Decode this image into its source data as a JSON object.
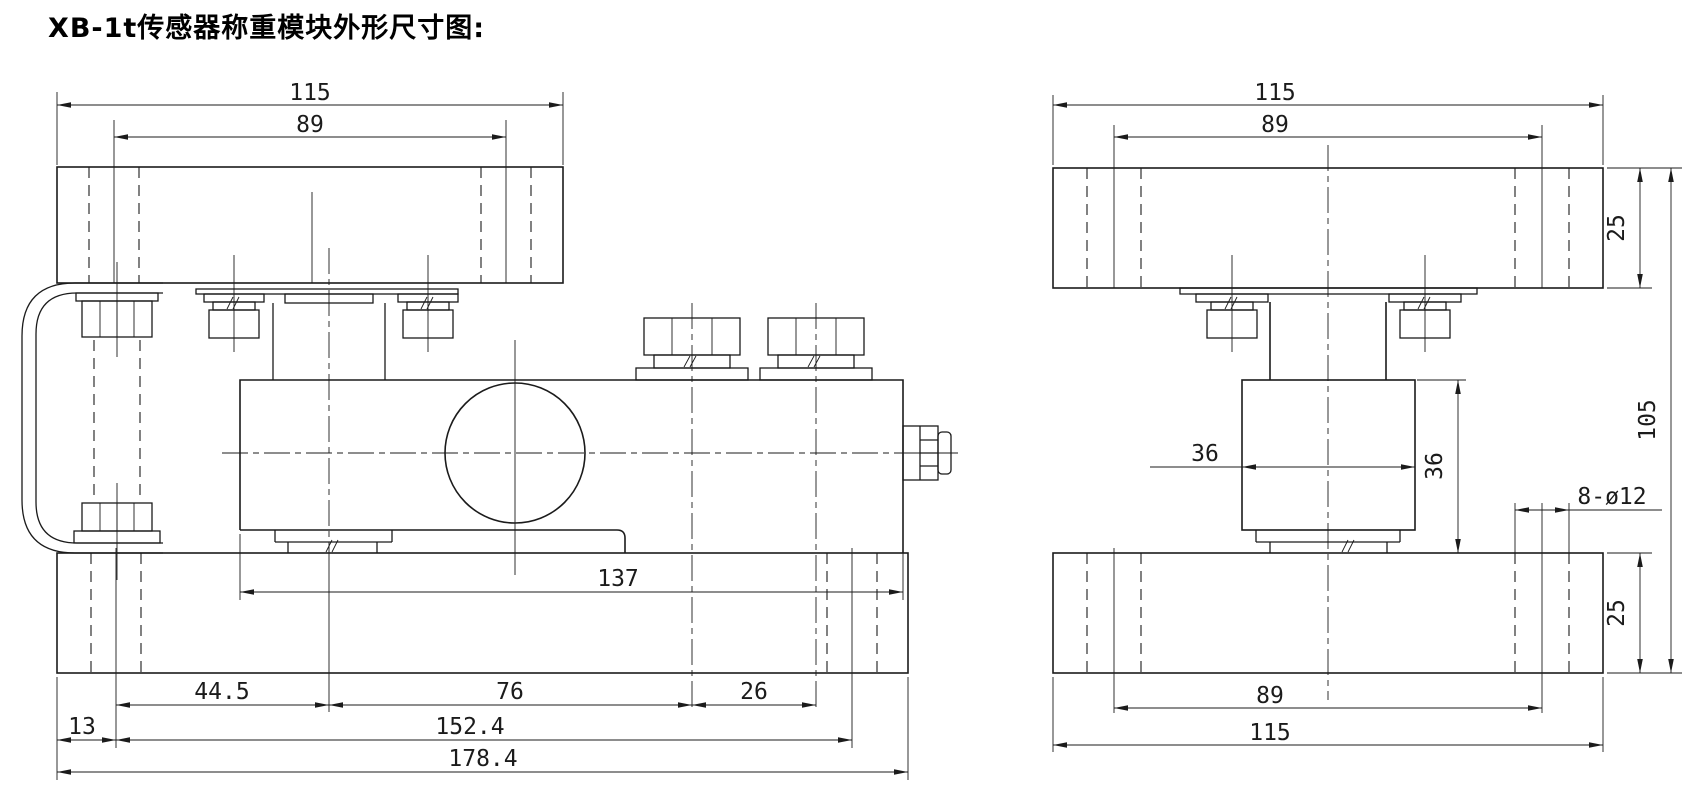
{
  "title": "XB-1t传感器称重模块外形尺寸图:",
  "side_view": {
    "dims": {
      "top_plate_width": "115",
      "top_hole_spacing": "89",
      "body_length": "137",
      "edge_to_hole": "13",
      "hole_to_center": "44.5",
      "center_to_bolt": "76",
      "bolt_spacing": "26",
      "bottom_hole_spacing": "152.4",
      "bottom_plate_length": "178.4"
    }
  },
  "end_view": {
    "dims": {
      "top_plate_width": "115",
      "top_hole_spacing": "89",
      "top_plate_thickness": "25",
      "overall_height": "105",
      "block_width": "36",
      "block_height": "36",
      "mounting_holes": "8-ø12",
      "bottom_plate_thickness": "25",
      "bottom_hole_spacing": "89",
      "bottom_plate_width": "115"
    }
  }
}
